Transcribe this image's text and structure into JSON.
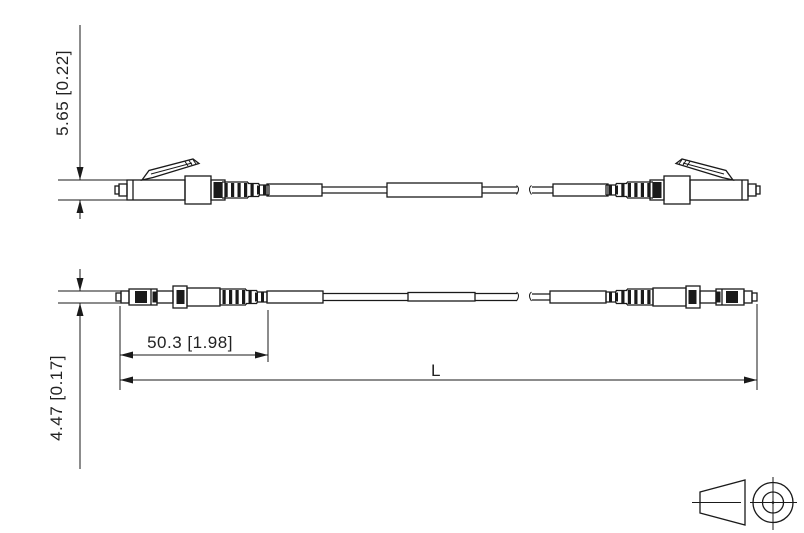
{
  "page": {
    "background": "#ffffff",
    "line_color": "#1a1a1a"
  },
  "drawing": {
    "type": "technical-drawing-fiber-patch-cord",
    "dimensions": {
      "connector_height": "5.65 [0.22]",
      "connector_width": "4.47 [0.17]",
      "connector_assembly_length": "50.3 [1.98]",
      "overall_length": "L"
    },
    "icons": {
      "projection": "third-angle-projection-icon"
    }
  }
}
